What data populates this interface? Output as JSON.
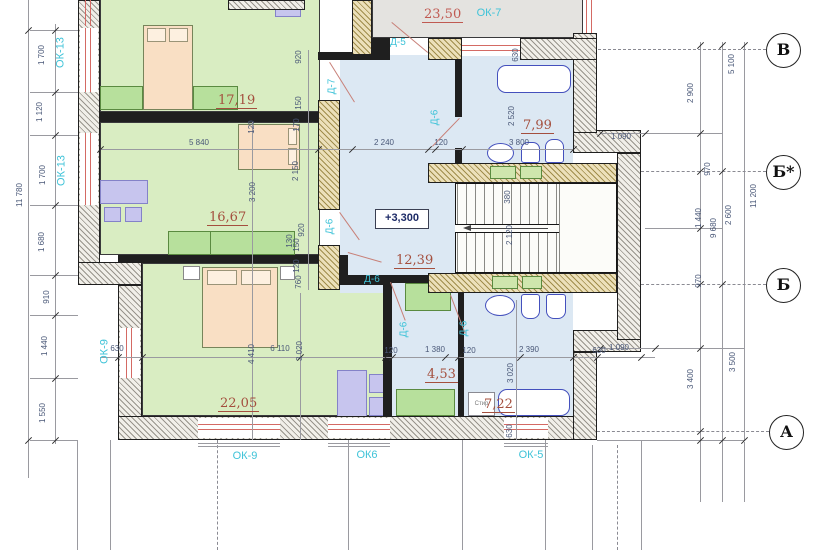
{
  "plan": {
    "elevation_mark": "+3,300",
    "areas": {
      "terrace": "23,50",
      "bedroom_top": "17,19",
      "bedroom_mid": "16,67",
      "bedroom_bottom": "22,05",
      "hall": "12,39",
      "bathroom_top": "7,99",
      "storage": "4,53",
      "bathroom_bottom": "7,22"
    },
    "windows": {
      "ok13_upper": "ОК-13",
      "ok13_lower": "ОК-13",
      "ok7": "ОК-7",
      "ok9_side": "ОК-9",
      "ok9_bottom": "ОК-9",
      "ok6": "ОК6",
      "ok5": "ОК-5"
    },
    "doors": {
      "d5": "Д-5",
      "d7": "Д-7",
      "d6_bath": "Д-6",
      "d6_bedroom": "Д-6",
      "d6_hall": "Д-6",
      "d6_storage": "Д-6",
      "d6_wc": "Д-6"
    },
    "grid_axes": {
      "v": "В",
      "b_star": "Б*",
      "b": "Б",
      "a": "А"
    },
    "appliances": {
      "washer": "Стир"
    },
    "dims": {
      "total_left": "11 780",
      "left": [
        "1 700",
        "1 120",
        "1 700",
        "1 680",
        "910",
        "1 440",
        "1 550"
      ],
      "right_inner": [
        "2 900",
        "970",
        "1 440",
        "970",
        "3 400"
      ],
      "right_sum": "9 680",
      "right_outer": [
        "5 100",
        "2 600",
        "3 500"
      ],
      "right_total": "11 200",
      "jog_top": "1 090",
      "jog_bottom": "1 090",
      "room_top_width": "5 840",
      "hall_width": "2 240",
      "wall_a": "120",
      "bath_top_width": "3 800",
      "win_offset_top": "630",
      "bath_top_depth": "2 520",
      "wall_chain": [
        "920",
        "150",
        "170",
        "2 150",
        "920",
        "150",
        "120",
        "760"
      ],
      "wall_b": "120",
      "bedroom_mid_depth": "3 200",
      "w130": "130",
      "stair_tread": "380",
      "stair_flight": "2 120",
      "bed_4410": "4 410",
      "bed_6110": "6 110",
      "bed_3020": "3 020",
      "st_chain": [
        "120",
        "1 380",
        "120",
        "2 390",
        "630"
      ],
      "wc_3020": "3 020",
      "wc_630": "630",
      "win_630_left": "630"
    }
  }
}
